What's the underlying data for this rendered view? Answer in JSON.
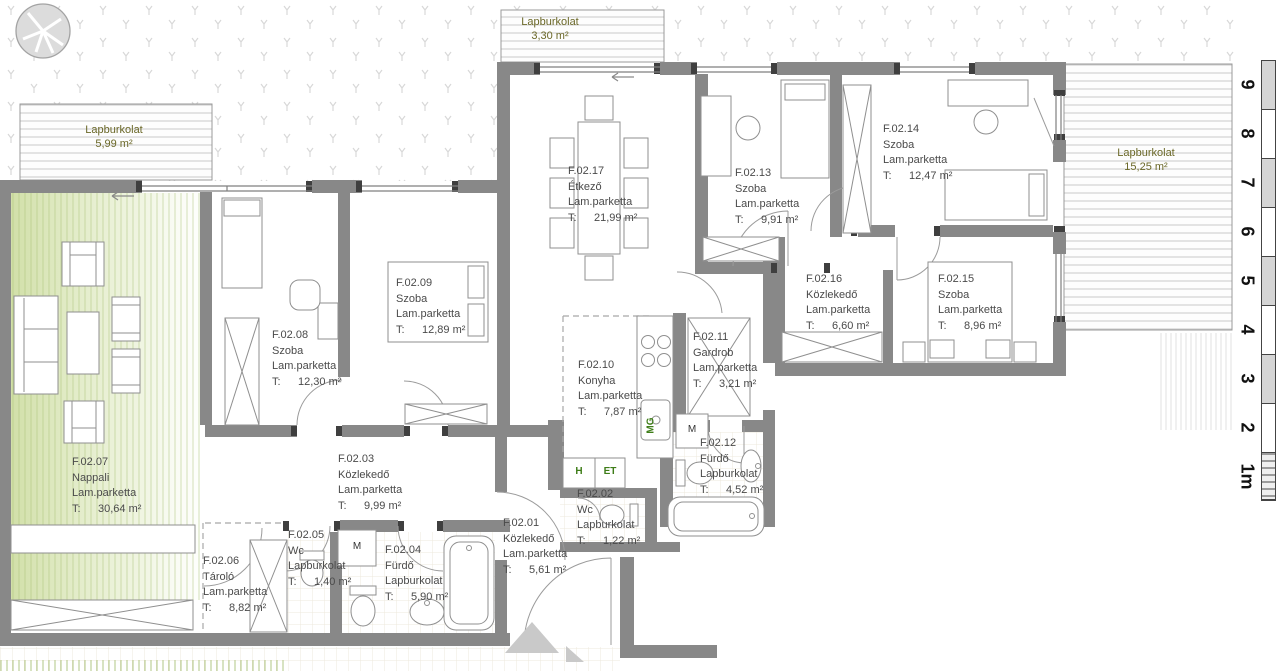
{
  "labels": {
    "t_prefix": "T:"
  },
  "outdoor_areas": [
    {
      "name": "Lapburkolat",
      "area": "5,99 m²"
    },
    {
      "name": "Lapburkolat",
      "area": "3,30 m²"
    },
    {
      "name": "Lapburkolat",
      "area": "15,25 m²"
    }
  ],
  "rooms": {
    "f0201": {
      "number": "F.02.01",
      "name": "Közlekedő",
      "flooring": "Lam.parketta",
      "area": "5,61 m²"
    },
    "f0202": {
      "number": "F.02.02",
      "name": "Wc",
      "flooring": "Lapburkolat",
      "area": "1,22 m²"
    },
    "f0203": {
      "number": "F.02.03",
      "name": "Közlekedő",
      "flooring": "Lam.parketta",
      "area": "9,99 m²"
    },
    "f0204": {
      "number": "F.02.04",
      "name": "Fürdő",
      "flooring": "Lapburkolat",
      "area": "5,90 m²"
    },
    "f0205": {
      "number": "F.02.05",
      "name": "Wc",
      "flooring": "Lapburkolat",
      "area": "1,40 m²"
    },
    "f0206": {
      "number": "F.02.06",
      "name": "Tároló",
      "flooring": "Lam.parketta",
      "area": "8,82 m²"
    },
    "f0207": {
      "number": "F.02.07",
      "name": "Nappali",
      "flooring": "Lam.parketta",
      "area": "30,64 m²"
    },
    "f0208": {
      "number": "F.02.08",
      "name": "Szoba",
      "flooring": "Lam.parketta",
      "area": "12,30 m²"
    },
    "f0209": {
      "number": "F.02.09",
      "name": "Szoba",
      "flooring": "Lam.parketta",
      "area": "12,89 m²"
    },
    "f0210": {
      "number": "F.02.10",
      "name": "Konyha",
      "flooring": "Lam.parketta",
      "area": "7,87 m²"
    },
    "f0211": {
      "number": "F.02.11",
      "name": "Gardrob",
      "flooring": "Lam.parketta",
      "area": "3,21 m²"
    },
    "f0212": {
      "number": "F.02.12",
      "name": "Fürdő",
      "flooring": "Lapburkolat",
      "area": "4,52 m²"
    },
    "f0213": {
      "number": "F.02.13",
      "name": "Szoba",
      "flooring": "Lam.parketta",
      "area": "9,91 m²"
    },
    "f0214": {
      "number": "F.02.14",
      "name": "Szoba",
      "flooring": "Lam.parketta",
      "area": "12,47 m²"
    },
    "f0215": {
      "number": "F.02.15",
      "name": "Szoba",
      "flooring": "Lam.parketta",
      "area": "8,96 m²"
    },
    "f0216": {
      "number": "F.02.16",
      "name": "Közlekedő",
      "flooring": "Lam.parketta",
      "area": "6,60 m²"
    },
    "f0217": {
      "number": "F.02.17",
      "name": "Étkező",
      "flooring": "Lam.parketta",
      "area": "21,99 m²"
    }
  },
  "markers": {
    "washing_machine": "M",
    "dishwasher": "MG",
    "fridge": "H",
    "et": "ET"
  },
  "scale_bar": {
    "labels": [
      "9",
      "8",
      "7",
      "6",
      "5",
      "4",
      "3",
      "2",
      "1m"
    ]
  }
}
